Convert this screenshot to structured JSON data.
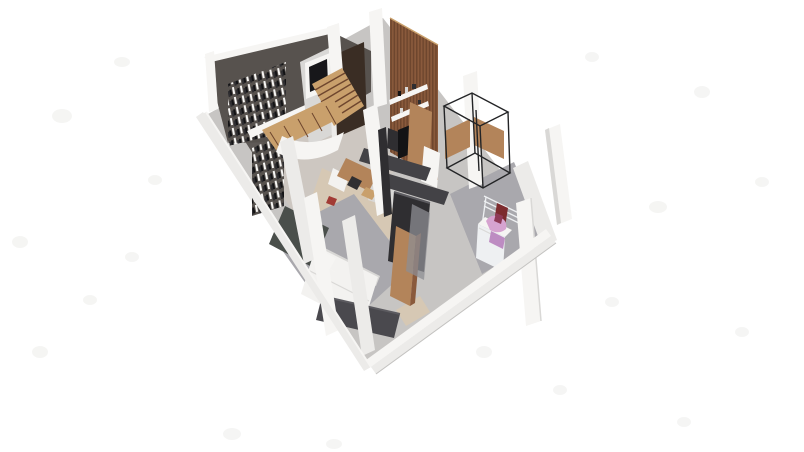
{
  "scene": {
    "type": "3d-isometric-floorplan-render",
    "description": "Isometric 3D cutaway render of a small studio apartment floor plan on a white background",
    "areas": [
      "living-area",
      "staircase",
      "kitchen",
      "bedroom",
      "bathroom-laundry"
    ]
  },
  "palette": {
    "background": "#ffffff",
    "artifact": "#f1f1ef",
    "floor_base": "#c7c5c3",
    "floor_dark": "#5f5a57",
    "floor_warm": "#cdc7c1",
    "floor_gray": "#a9a8ad",
    "floor_wood": "#d6c8b4",
    "wall_white": "#ecebe9",
    "wall_bright": "#f6f5f3",
    "wall_shade": "#d9d8d6",
    "wall_edge": "#c3c2c0",
    "dark_wall": "#57524e",
    "door_brown": "#3a2d24",
    "glass_dark": "#17171a",
    "wood": "#b3845a",
    "wood_light": "#c9a06c",
    "wood_dark": "#8a5a3c",
    "wood_deep": "#6e462e",
    "charcoal": "#434246",
    "charcoal_dark": "#2f2e31",
    "charcoal_light": "#5c5b60",
    "black": "#131315",
    "metal": "#232426",
    "rug": "#4a4f4b",
    "bed_white": "#f3f2f0",
    "bench": "#4a494e",
    "pink": "#d6a3d0",
    "pink_deep": "#bd8cc2",
    "red_dark": "#7c2b2e",
    "red_accent": "#a23b35",
    "magenta_dark": "#8e3a57",
    "glass_gray": "#8e8d93",
    "machine_white": "#eef0f2"
  }
}
